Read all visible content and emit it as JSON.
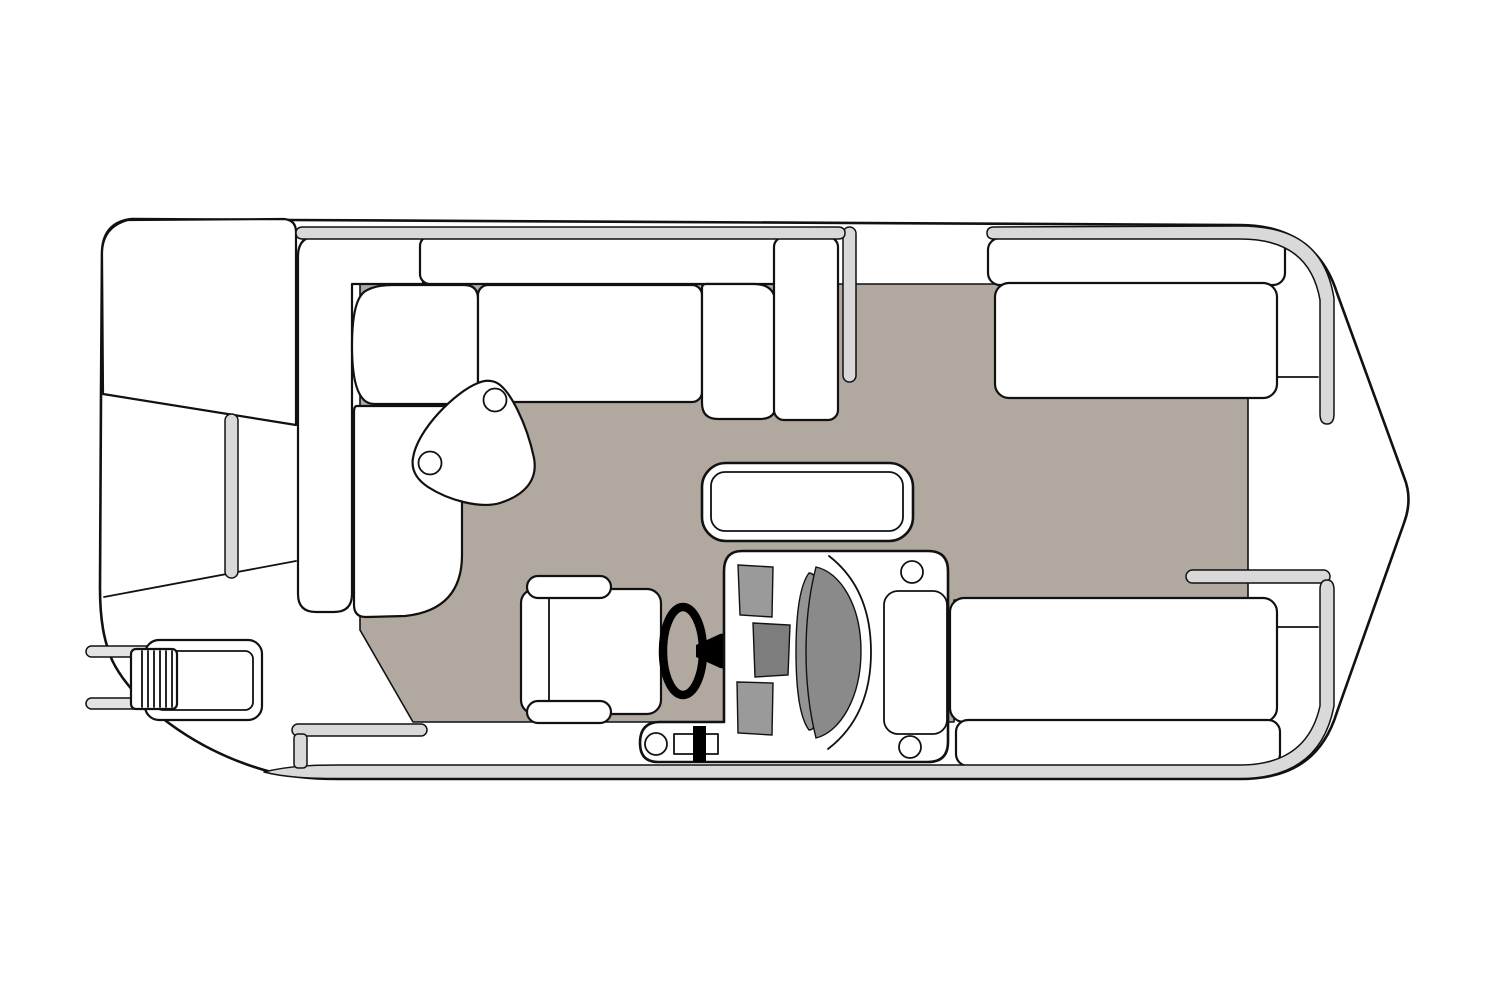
{
  "diagram": {
    "type": "floor-plan",
    "subject": "pontoon-boat-top-view",
    "orientation": "bow-right-stern-left",
    "canvas": {
      "width": 1505,
      "height": 1003
    },
    "colors": {
      "background": "#ffffff",
      "outline": "#111111",
      "deck": "#ffffff",
      "floor": "#b1a9a0",
      "rail": "#d9d9d9",
      "rail_light": "#e3e3e3",
      "console_gray": "#9a9a9a",
      "console_gray_dark": "#7d7d7d",
      "windshield_gray": "#8a8a8a",
      "lens_gray": "#949494",
      "wheel_black": "#000000"
    },
    "components": [
      "hull-outline",
      "motor-pod",
      "stern-deck-line",
      "deck-floor",
      "stern-rail-post",
      "aft-grab-rails",
      "boarding-ladder",
      "port-sofa-backrest",
      "port-sofa-corner-cushion",
      "port-sofa-long-cushion",
      "port-sofa-deep-cushion",
      "port-sofa-end-piece",
      "port-sofa-side-cushion",
      "triangle-table",
      "cup-holders",
      "top-rail-stern-section",
      "top-rail-bow-section",
      "bottom-rail",
      "side-gate-post",
      "stern-gate-bar",
      "bow-gate-bar",
      "bow-bench-port",
      "bow-bench-starboard",
      "cooler-table",
      "captains-chair",
      "steering-wheel",
      "helm-console",
      "console-cupholders",
      "throttle-lever",
      "windshield"
    ]
  }
}
